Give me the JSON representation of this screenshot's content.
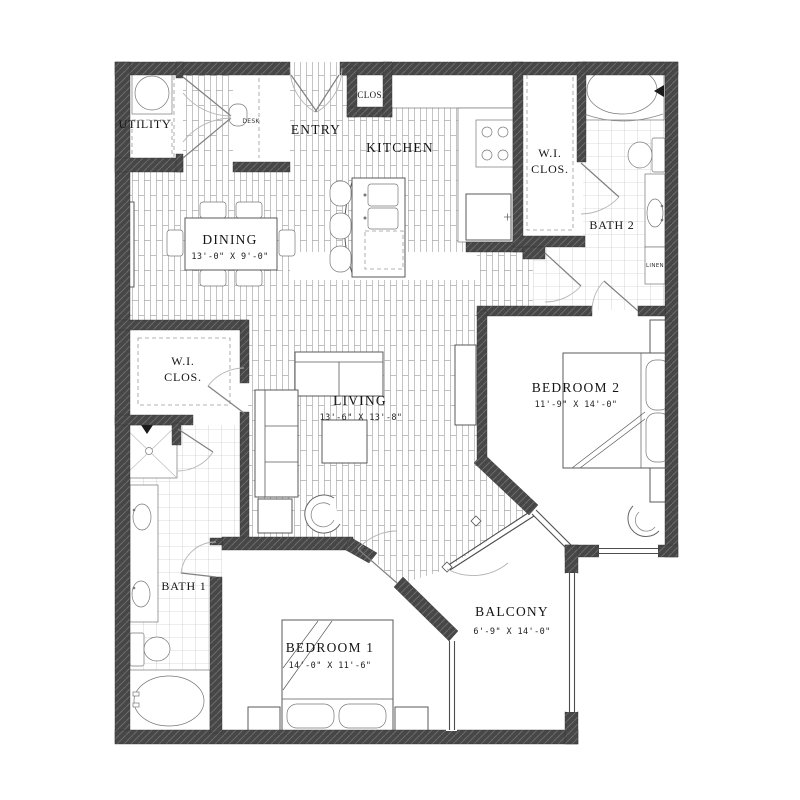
{
  "rooms": {
    "utility": {
      "name": "UTILITY"
    },
    "entry": {
      "name": "ENTRY"
    },
    "entry_closet": {
      "name": "CLOS."
    },
    "desk_nook": {
      "name": "DESK"
    },
    "kitchen": {
      "name": "KITCHEN"
    },
    "wic_top": {
      "line1": "W.I.",
      "line2": "CLOS."
    },
    "bath2": {
      "name": "BATH 2"
    },
    "linen": {
      "name": "LINEN"
    },
    "dining": {
      "name": "DINING",
      "dims": "13'-0\" X 9'-0\""
    },
    "wic_left": {
      "line1": "W.I.",
      "line2": "CLOS."
    },
    "living": {
      "name": "LIVING",
      "dims": "13'-6\" X 13'-8\""
    },
    "bedroom2": {
      "name": "BEDROOM 2",
      "dims": "11'-9\" X 14'-0\""
    },
    "bath1": {
      "name": "BATH 1"
    },
    "bedroom1": {
      "name": "BEDROOM 1",
      "dims": "14'-0\" X 11'-6\""
    },
    "balcony": {
      "name": "BALCONY",
      "dims": "6'-9\" X 14'-0\""
    }
  },
  "colors": {
    "wall": "#474747",
    "wall_hatch": "#6b6b6b",
    "wood_floor_line": "#ababab",
    "tile_line": "#b8b8b8",
    "furniture_line": "#5a5a5a",
    "text": "#141414",
    "background": "#ffffff"
  }
}
